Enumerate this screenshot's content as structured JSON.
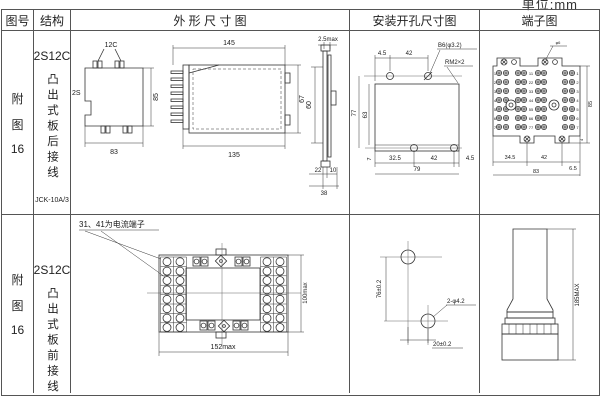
{
  "page": {
    "unit_label": "单位:mm"
  },
  "headers": {
    "fig_no": "图号",
    "structure": "结构",
    "outline": "外 形 尺 寸 图",
    "mounting": "安装开孔尺寸图",
    "terminal": "端子图"
  },
  "rows": [
    {
      "fig": {
        "a": "附",
        "b": "图",
        "c": "16"
      },
      "structure": {
        "model": "2S12C",
        "type": "凸出式板后接线",
        "product": "JCK-10A/3"
      },
      "outline": {
        "front": {
          "top": "12C",
          "left": "2S",
          "width": "83",
          "height": "85"
        },
        "side": {
          "top": "145",
          "bottom": "135",
          "right": "67"
        },
        "flange": {
          "top": "2.5max",
          "left": "60",
          "b1": "22",
          "b2": "10",
          "total": "38"
        }
      },
      "mounting": {
        "t1": "4.5",
        "t2": "42",
        "hole_label": "B6(φ3.2)",
        "thread_label": "RM2×2",
        "left_outer": "77",
        "left_inner": "63",
        "b0": "7",
        "b1": "32.5",
        "b2": "42",
        "b3": "4.5",
        "total": "79"
      },
      "terminal": {
        "top_label": "φ6",
        "numbers": [
          "1",
          "2",
          "3",
          "4",
          "5",
          "6",
          "7"
        ],
        "pairs": [
          "11",
          "22",
          "33",
          "44",
          "55",
          "66",
          "77"
        ],
        "b1": "34.5",
        "b2": "42",
        "b3": "6.5",
        "total": "83",
        "right": "85",
        "small": "4"
      }
    },
    {
      "fig": {
        "a": "附",
        "b": "图",
        "c": "16"
      },
      "structure": {
        "model": "2S12C",
        "type": "凸出式板前接线",
        "product": "JCK-10A/3"
      },
      "outline": {
        "note": "31、41为电流端子",
        "width": "152max",
        "height": "100max"
      },
      "mounting": {
        "v": "76±0.2",
        "h": "20±0.2",
        "label": "2-φ4.2"
      },
      "terminal": {
        "height": "185MAX"
      }
    }
  ]
}
